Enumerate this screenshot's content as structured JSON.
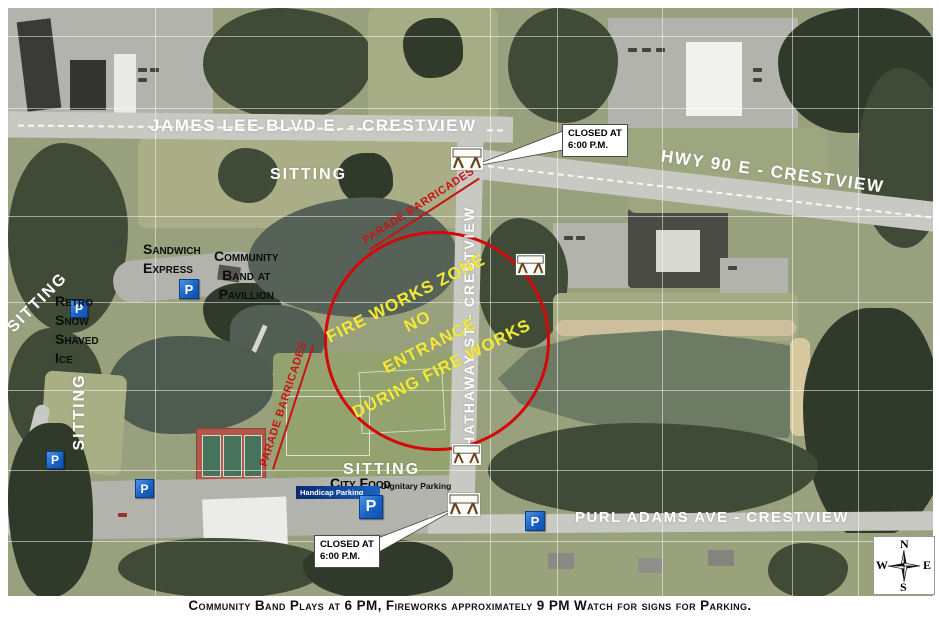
{
  "map": {
    "roads": {
      "james_lee": "JAMES LEE BLVD E. - CRESTVIEW",
      "hwy_90": "HWY 90 E - CRESTVIEW",
      "hathaway": "S HATHAWAY ST - CRESTVIEW",
      "purl_adams": "PURL ADAMS AVE - CRESTVIEW"
    },
    "areas": {
      "sitting": "SITTING"
    },
    "vendors": {
      "sandwich_express": "Sandwich\nExpress",
      "community_band": "Community\nBand at\nPavillion",
      "retro_snow": "Retro\nSnow\nShaved\nIce",
      "city_food": "City Food"
    },
    "parking": {
      "p_label": "P",
      "handicap": "Handicap Parking",
      "dignitary": "Dignitary Parking"
    },
    "fireworks_zone": "FIRE WORKS ZONE\nNO\nENTRANCE\nDURING FIRE WORKS",
    "parade_barricades": "PARADE BARRICADES",
    "closed_note": "CLOSED AT\n6:00 P.M.",
    "compass": {
      "n": "N",
      "e": "E",
      "s": "S",
      "w": "W"
    }
  },
  "caption": "Community Band Plays at 6 PM,  Fireworks approximately 9 PM  Watch for signs for Parking.",
  "colors": {
    "fireworks_text": "#f2ea38",
    "zone_circle": "#d40808",
    "barricade_text": "#c81414",
    "parking_blue": "#1b63c4",
    "road_label": "#ffffff"
  }
}
